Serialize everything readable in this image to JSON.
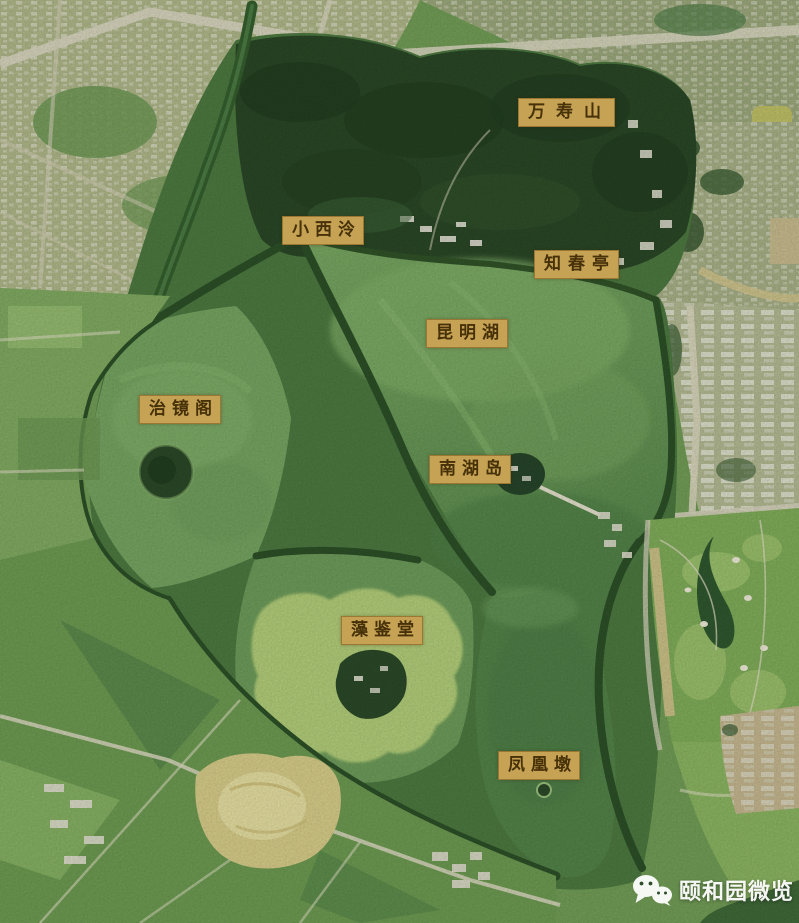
{
  "map": {
    "region_name_labels": [
      {
        "text": "万寿山",
        "left": 518,
        "top": 98,
        "ls": 11
      },
      {
        "text": "小西泠",
        "left": 282,
        "top": 216,
        "ls": 6
      },
      {
        "text": "知春亭",
        "left": 534,
        "top": 250,
        "ls": 7
      },
      {
        "text": "昆明湖",
        "left": 426,
        "top": 319,
        "ls": 6
      },
      {
        "text": "治镜阁",
        "left": 139,
        "top": 395,
        "ls": 6
      },
      {
        "text": "南湖岛",
        "left": 429,
        "top": 455,
        "ls": 6
      },
      {
        "text": "藻鉴堂",
        "left": 341,
        "top": 616,
        "ls": 6
      },
      {
        "text": "凤凰墩",
        "left": 498,
        "top": 751,
        "ls": 6
      }
    ],
    "watermark": {
      "text": "颐和园微览",
      "icon": "wechat-logo-icon"
    },
    "colors": {
      "label_bg": "#c6a254",
      "label_text": "#463108",
      "watermark_text": "#ffffff",
      "lake_green": "#6f9e5c",
      "south_lake_green": "#54854a",
      "forest_green": "#2b4827",
      "dike_green": "#2d5128",
      "algae_light_green": "#b9d47d",
      "urban_light": "#b2ba8b",
      "sand_yellow": "#dbd08c",
      "road_light": "#dcd9c2"
    }
  }
}
